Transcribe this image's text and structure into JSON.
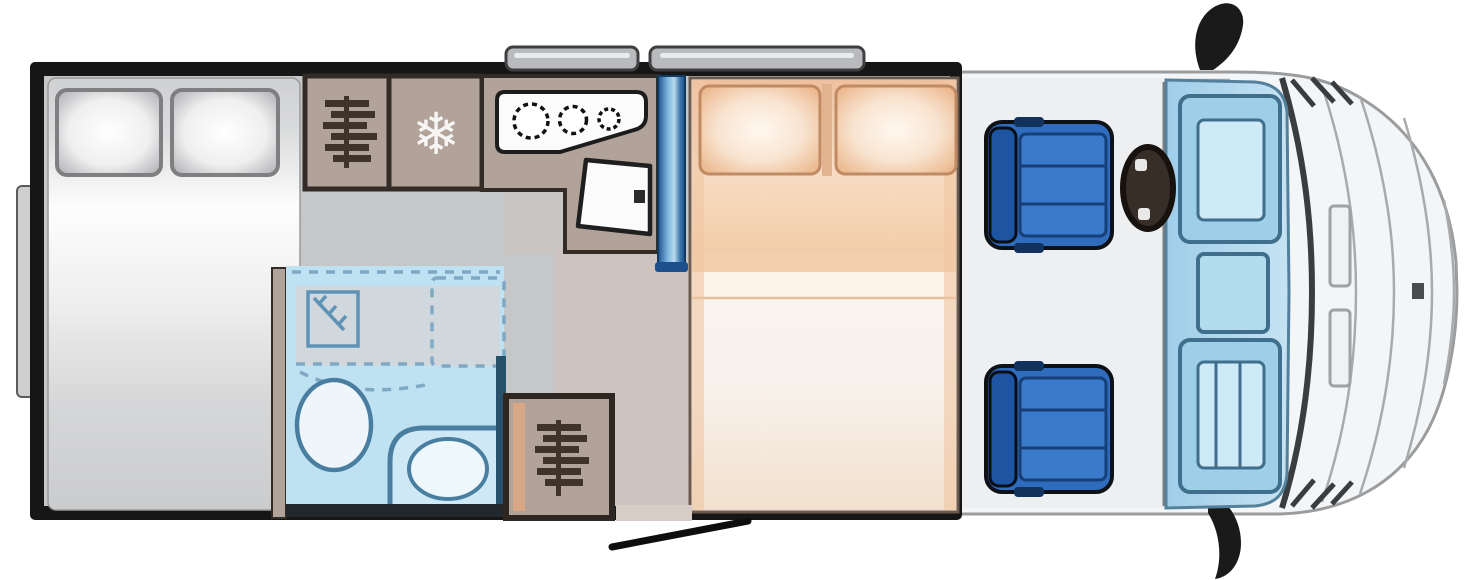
{
  "diagram": {
    "kind": "motorhome-floorplan-top-view"
  },
  "colors": {
    "wall": "#161616",
    "floor": "#c6c7c9",
    "corridor_tint": "#d9bfae",
    "cabinet": "#b1a39a",
    "cabinet_border": "#332b25",
    "bed_grey": "#d6d7d9",
    "bed_orange": "#f2c9a7",
    "bed_cream": "#f8f2ec",
    "bathroom_fill": "#bfe2f3",
    "bathroom_line": "#4a7ea0",
    "partition_blue": "#2f6fb2",
    "seat_blue": "#2f6cbe",
    "seat_blue_dark": "#1d55a2",
    "glass_blue": "#b7dbee",
    "glass_line": "#3f6f8c",
    "body_fill": "#f4f5f6",
    "body_line": "#8f9194",
    "icon_dark": "#3f332a",
    "window_grey": "#b9babc",
    "steering_wheel": "#382e28",
    "mirror_black": "#1a1a1a",
    "hob_white": "#fbfbfb"
  },
  "icons": {
    "fridge": {
      "name": "snowflake-icon",
      "glyph": "❄"
    },
    "wardrobe": {
      "name": "clothes-hangers-icon"
    },
    "hob": {
      "name": "three-burner-hob-icon"
    },
    "shower": {
      "name": "shower-tray-icon"
    }
  },
  "features": {
    "rear_bed_pillows": 2,
    "mid_bed_pillows": 2,
    "hob_burners": 3,
    "wardrobes": 2,
    "swivel_seats": 2,
    "top_wall_windows": 2,
    "side_mirrors": 2
  }
}
